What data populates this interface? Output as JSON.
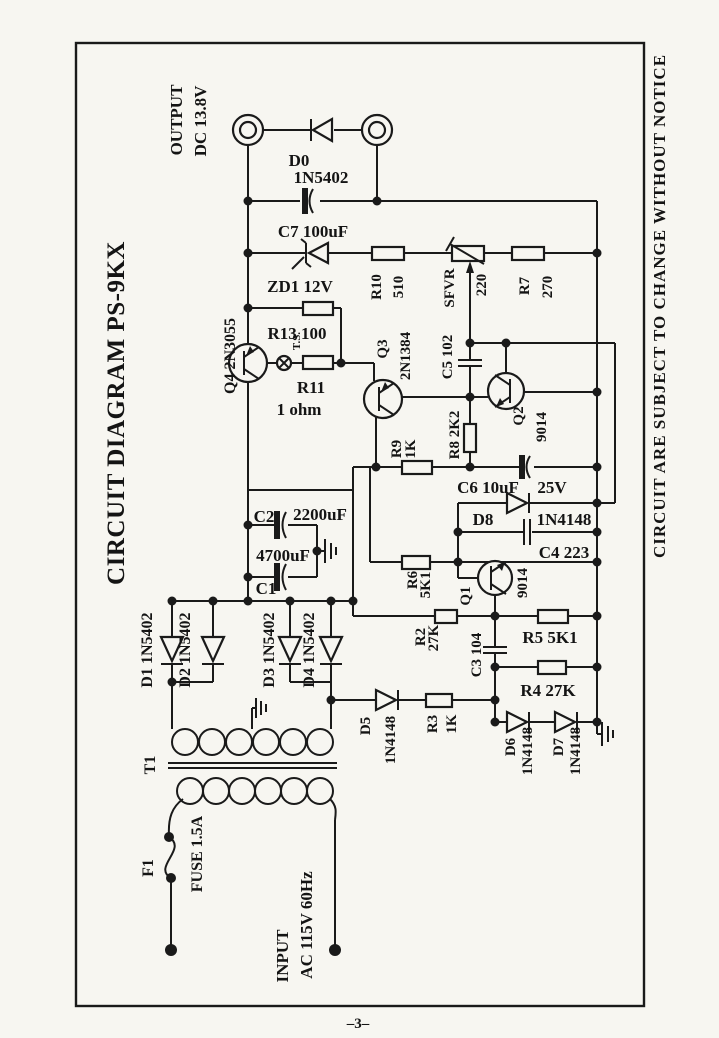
{
  "page": {
    "number": "–3–"
  },
  "header": {
    "title": "CIRCUIT DIAGRAM PS-9KX",
    "notice": "CIRCUIT ARE SUBJECT TO CHANGE WITHOUT NOTICE"
  },
  "terminals": {
    "output_line1": "OUTPUT",
    "output_line2": "DC 13.8V",
    "input_line1": "INPUT",
    "input_line2": "AC 115V 60Hz"
  },
  "transformer": {
    "ref": "T1"
  },
  "fuse": {
    "ref": "F1",
    "value": "FUSE 1.5A"
  },
  "components": {
    "d0_ref": "D0",
    "d0_val": "1N5402",
    "c7": "C7 100uF",
    "zd1": "ZD1 12V",
    "r10_ref": "R10",
    "r10_val": "510",
    "svr_ref": "SFVR",
    "svr_val": "220",
    "r7_ref": "R7",
    "r7_val": "270",
    "q4": "Q4 2N3055",
    "r13": "R13 100",
    "ts": "T.S.",
    "r11_ref": "R11",
    "r11_val": "1 ohm",
    "q3_ref": "Q3",
    "q3_val": "2N1384",
    "c5": "C5 102",
    "r9_ref": "R9",
    "r9_val": "1K",
    "r8": "R8 2K2",
    "q2_ref": "Q2",
    "q2_val": "9014",
    "c6_ref": "C6 10uF",
    "c6_val": "25V",
    "d8_ref": "D8",
    "d8_val": "1N4148",
    "c4": "C4 223",
    "c2_ref": "C2",
    "c2_val": "2200uF",
    "c1_ref": "C1",
    "c1_val": "4700uF",
    "r6_ref": "R6",
    "r6_val": "5K1",
    "q1_ref": "Q1",
    "q1_val": "9014",
    "r2_ref": "R2",
    "r2_val": "27K",
    "c3": "C3 104",
    "r5": "R5 5K1",
    "r4": "R4 27K",
    "d1": "D1 1N5402",
    "d2": "D2 1N5402",
    "d3": "D3 1N5402",
    "d4": "D4 1N5402",
    "d5_ref": "D5",
    "d5_val": "1N4148",
    "r3_ref": "R3",
    "r3_val": "1K",
    "d6_ref": "D6",
    "d6_val": "1N4148",
    "d7_ref": "D7",
    "d7_val": "1N4148"
  }
}
